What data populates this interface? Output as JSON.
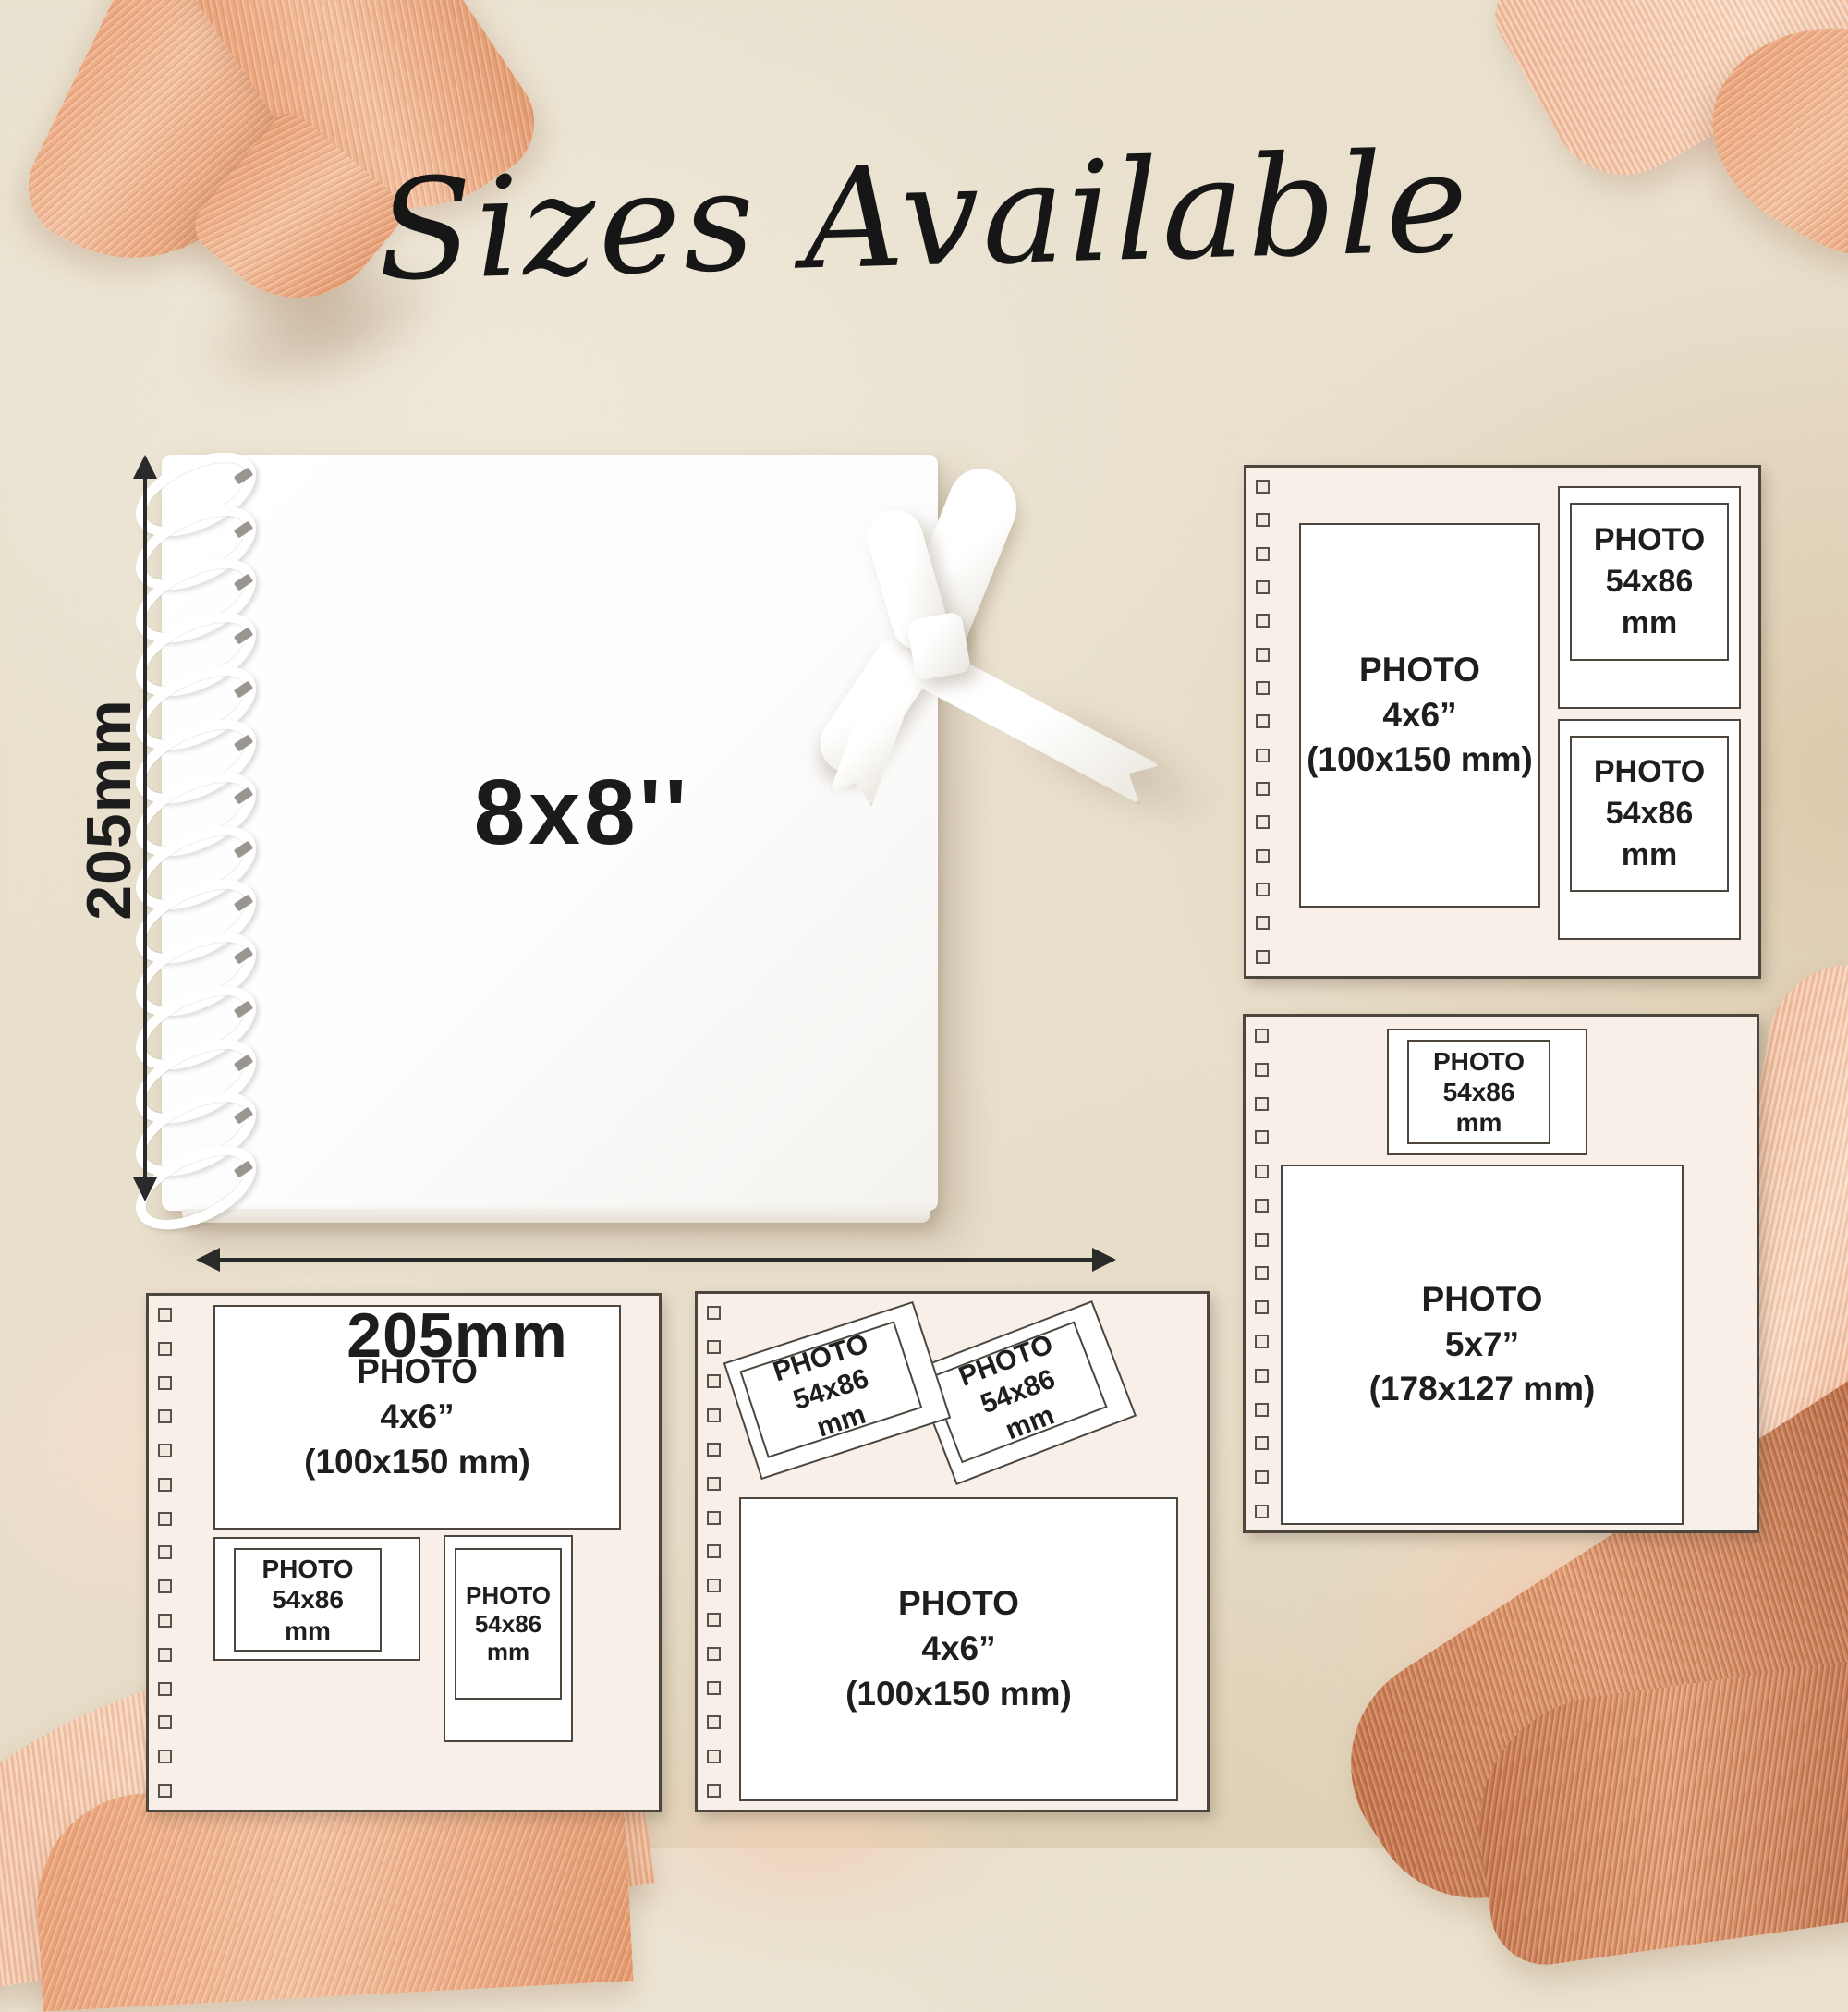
{
  "title": "Sizes Available",
  "book": {
    "size_label": "8x8''",
    "height_label": "205mm",
    "width_label": "205mm"
  },
  "panels": {
    "top_right": {
      "photo_4x6": "PHOTO\n4x6”\n(100x150 mm)",
      "photo_small_1": "PHOTO\n54x86\nmm",
      "photo_small_2": "PHOTO\n54x86\nmm"
    },
    "middle_right": {
      "photo_small": "PHOTO\n54x86\nmm",
      "photo_5x7": "PHOTO\n5x7”\n(178x127 mm)"
    },
    "bottom_left": {
      "photo_4x6": "PHOTO\n4x6”\n(100x150 mm)",
      "photo_small_1": "PHOTO\n54x86\nmm",
      "photo_small_2": "PHOTO\n54x86\nmm"
    },
    "bottom_middle": {
      "photo_small_1": "PHOTO\n54x86\nmm",
      "photo_small_2": "PHOTO\n54x86\nmm",
      "photo_4x6": "PHOTO\n4x6”\n(100x150 mm)"
    }
  },
  "colors": {
    "background": "#e8dfcc",
    "panel_bg": "#f8efe8",
    "panel_border": "#4c463f",
    "text": "#1e1e1e",
    "ribbon": "#f0b18d",
    "ribbon_dark": "#c97a52"
  }
}
